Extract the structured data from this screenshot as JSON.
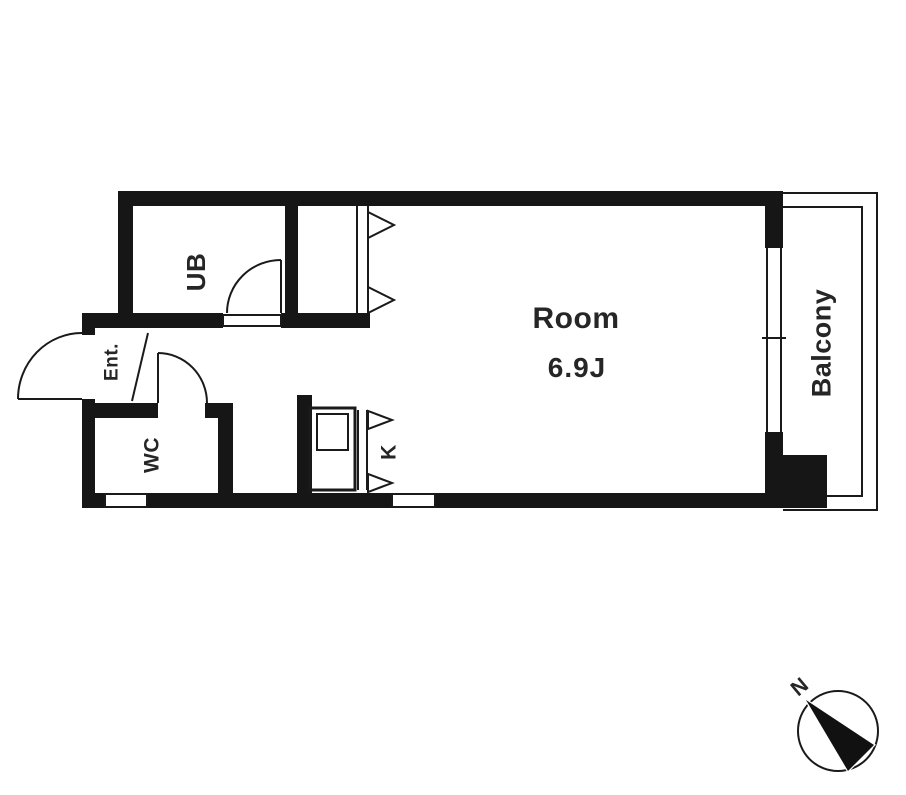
{
  "plan": {
    "rooms": {
      "unit_bath": {
        "label": "UB"
      },
      "entrance": {
        "label": "Ent."
      },
      "toilet": {
        "label": "WC"
      },
      "kitchen": {
        "label": "K"
      },
      "main_room": {
        "label": "Room",
        "size": "6.9J"
      },
      "balcony": {
        "label": "Balcony"
      }
    },
    "compass": {
      "north_label": "N"
    },
    "colors": {
      "wall": "#161616",
      "line": "#1a1a1a",
      "text": "#262626",
      "background": "#ffffff"
    }
  }
}
